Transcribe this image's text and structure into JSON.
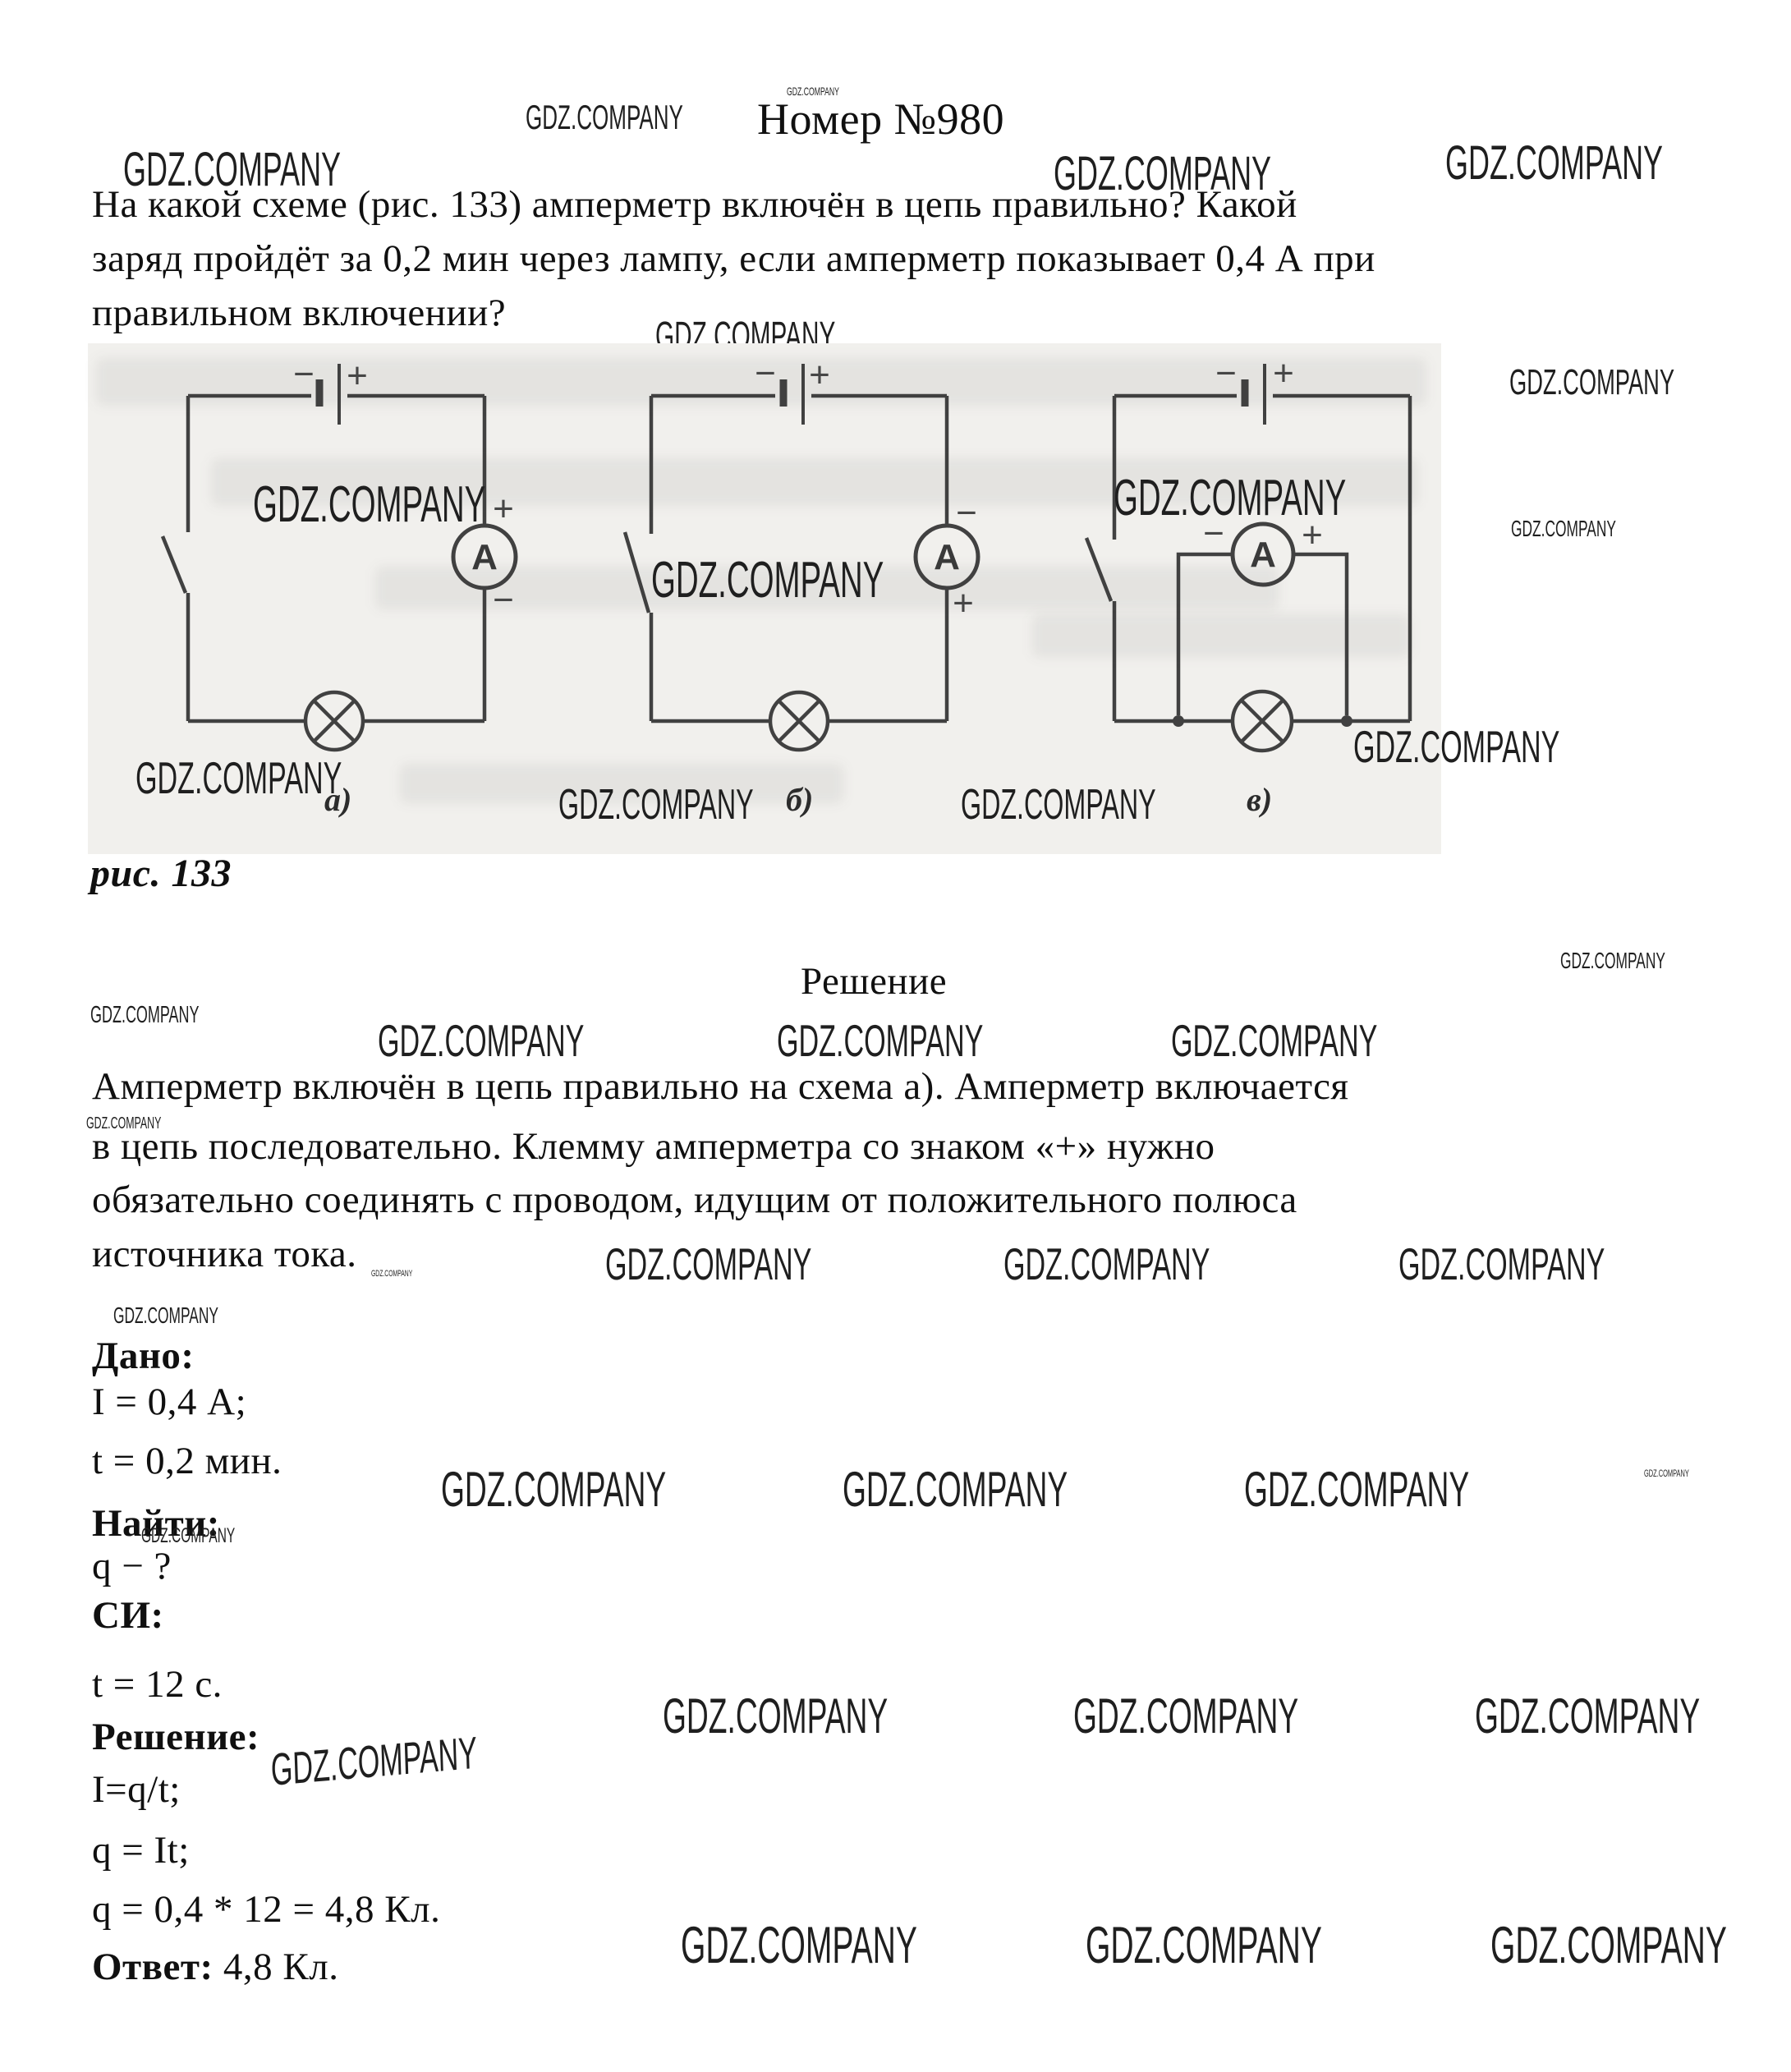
{
  "watermark": "GDZ.COMPANY",
  "header": {
    "title": "Номер №980"
  },
  "problem": {
    "line1": "На какой схеме (рис. 133) амперметр включён в цепь правильно? Какой",
    "line2": "заряд пройдёт за 0,2 мин через лампу, если амперметр показывает 0,4 А при",
    "line3": "правильном включении?"
  },
  "figure": {
    "caption": "рис. 133",
    "plus": "+",
    "minus": "−",
    "ammeter_letter": "А",
    "labels": {
      "a": "а)",
      "b": "б)",
      "v": "в)"
    }
  },
  "solution": {
    "heading": "Решение",
    "para_line1": "Амперметр включён в цепь правильно на схема а). Амперметр включается",
    "para_line2": "в цепь последовательно. Клемму амперметра со знаком «+» нужно",
    "para_line3": "обязательно соединять с проводом, идущим от положительного полюса",
    "para_line4": "источника тока.",
    "given_label": "Дано:",
    "given_current": "I = 0,4 А;",
    "given_time": "t = 0,2 мин.",
    "find_label": "Найти:",
    "find_value": "q − ?",
    "si_label": "СИ:",
    "si_value": "t = 12 с.",
    "steps_label": "Решение:",
    "step1": "I=q/t;",
    "step2": "q = It;",
    "step3": "q = 0,4 * 12 = 4,8 Кл.",
    "answer_label": "Ответ:",
    "answer_value": " 4,8 Кл."
  }
}
